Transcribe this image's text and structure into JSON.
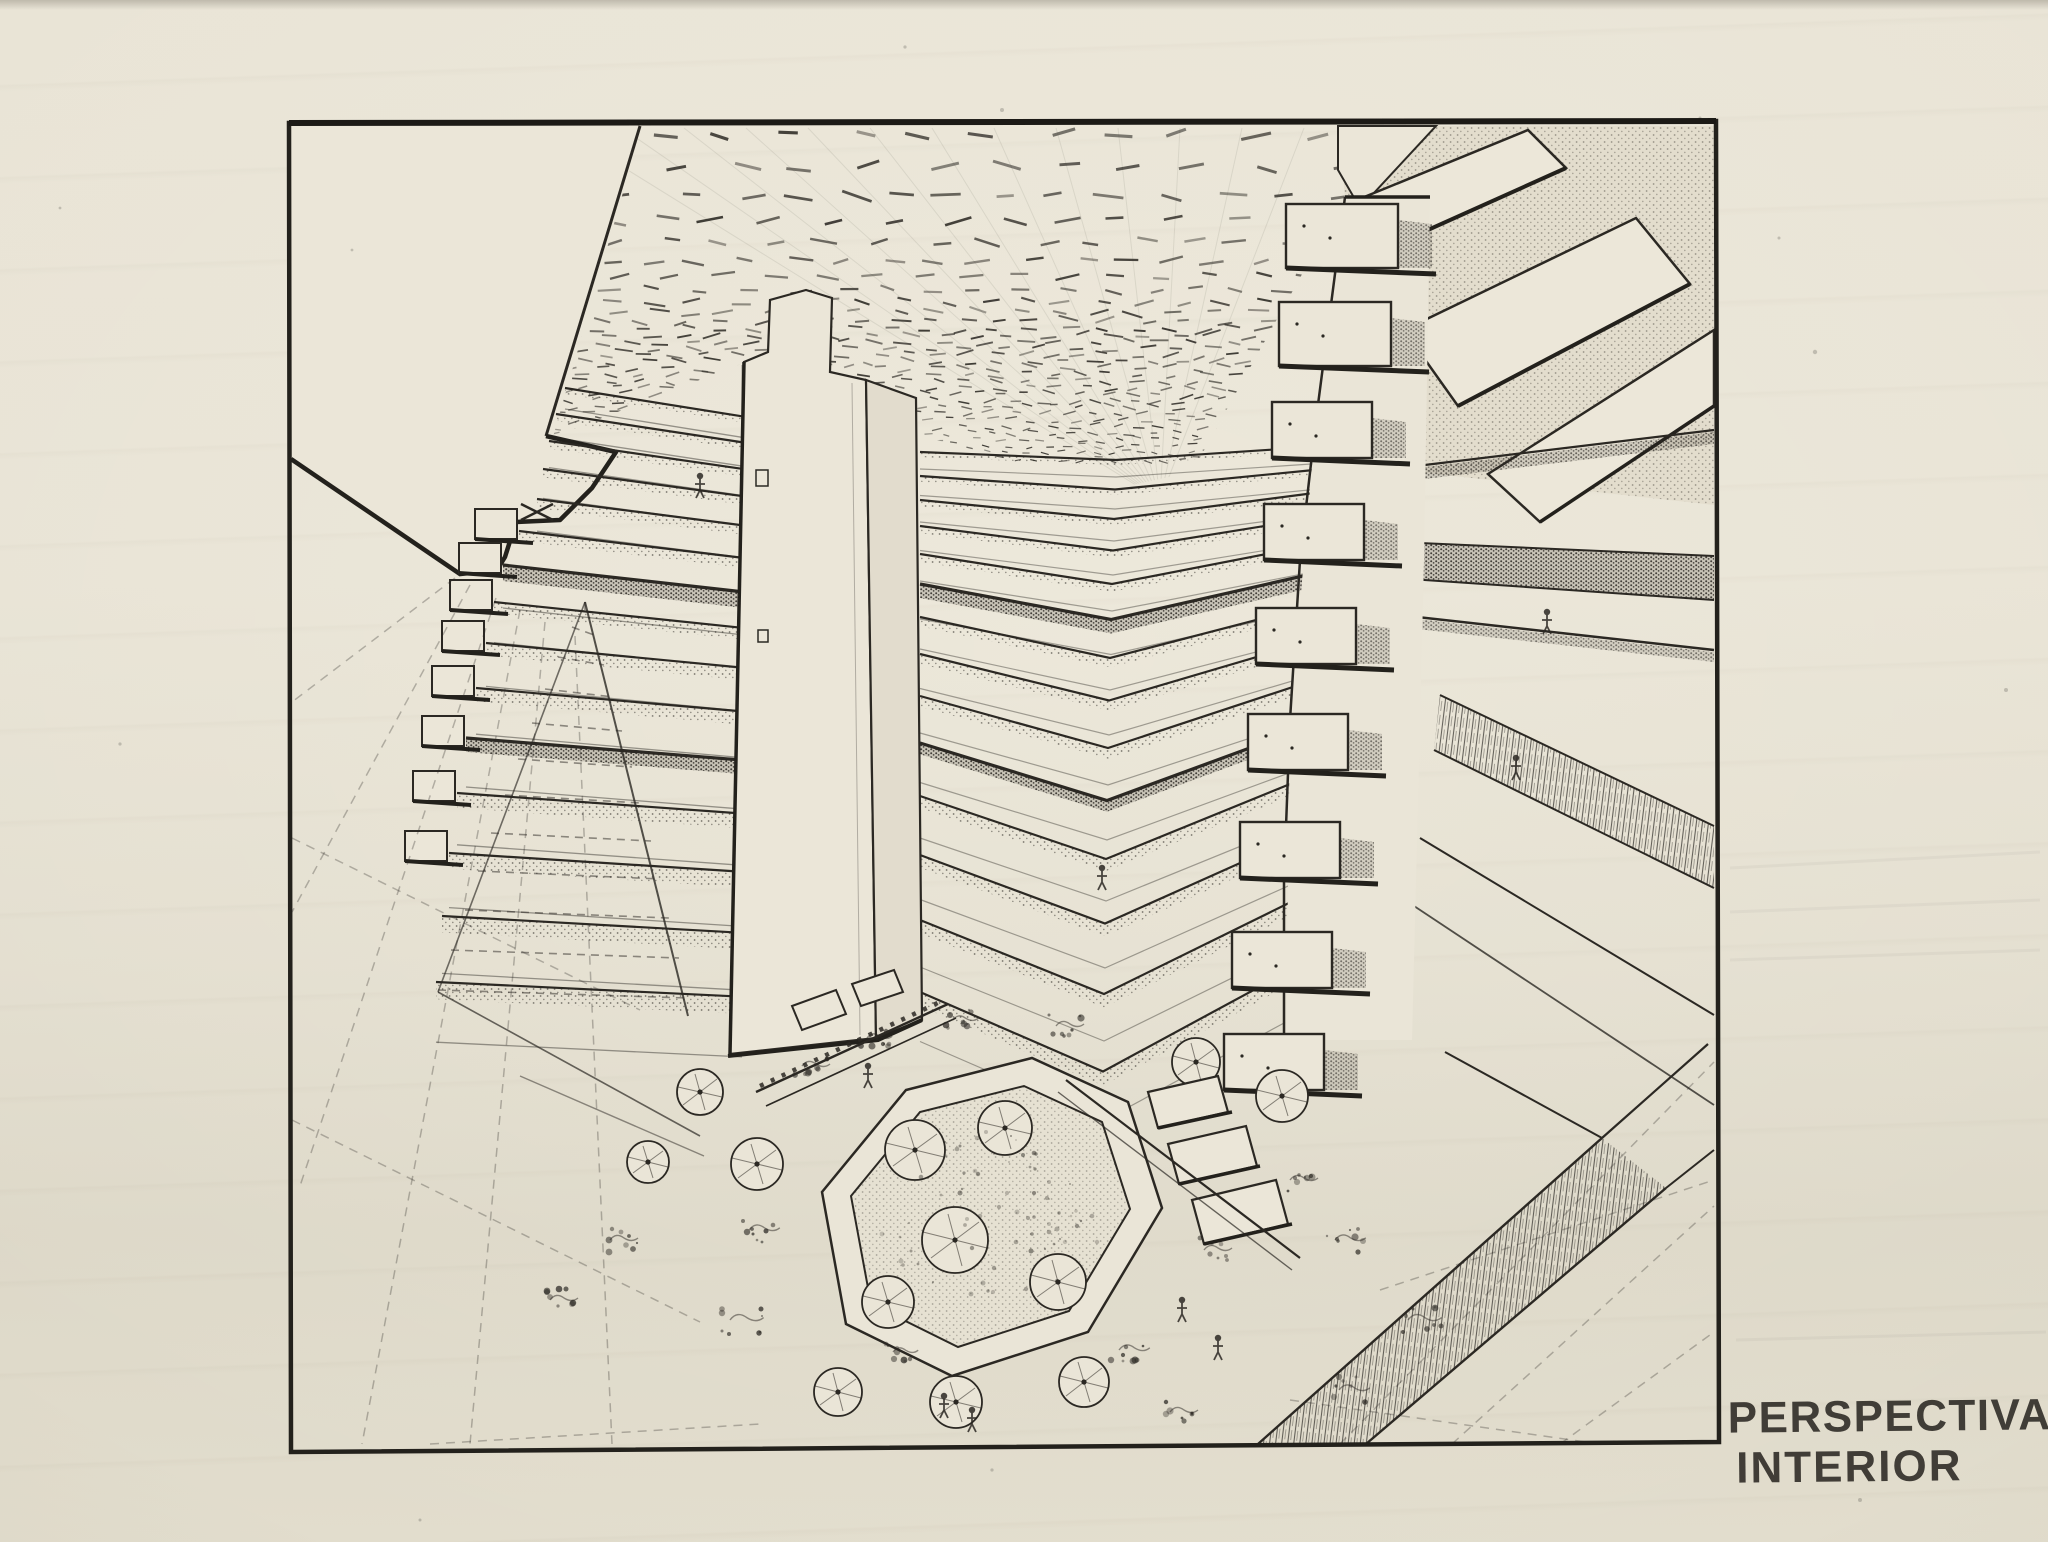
{
  "caption": {
    "line1": "PERSPECTIVA",
    "line2": "INTERIOR"
  },
  "palette": {
    "paper": "#e8e3d5",
    "paper_light": "#ebe6d8",
    "paper_dim": "#ddd7c6",
    "ink": "#2b2823",
    "ink_soft": "#55514a"
  },
  "scene": {
    "subject": "atrium interior perspective drawing",
    "elements": [
      "drawing-frame-border",
      "dotted-skylight-ceiling-grid",
      "blank-left-wall",
      "tiered-left-balconies",
      "central-elevator-tower",
      "chevron-corner-balconies",
      "right-pier-with-planter-boxes",
      "upper-right-diagonal-bridges",
      "far-right-balcony-bands",
      "octagonal-plaza-with-cafe-tables",
      "floor-tile-grid",
      "stair-fan",
      "bottom-right-ramp",
      "caption-text"
    ]
  }
}
